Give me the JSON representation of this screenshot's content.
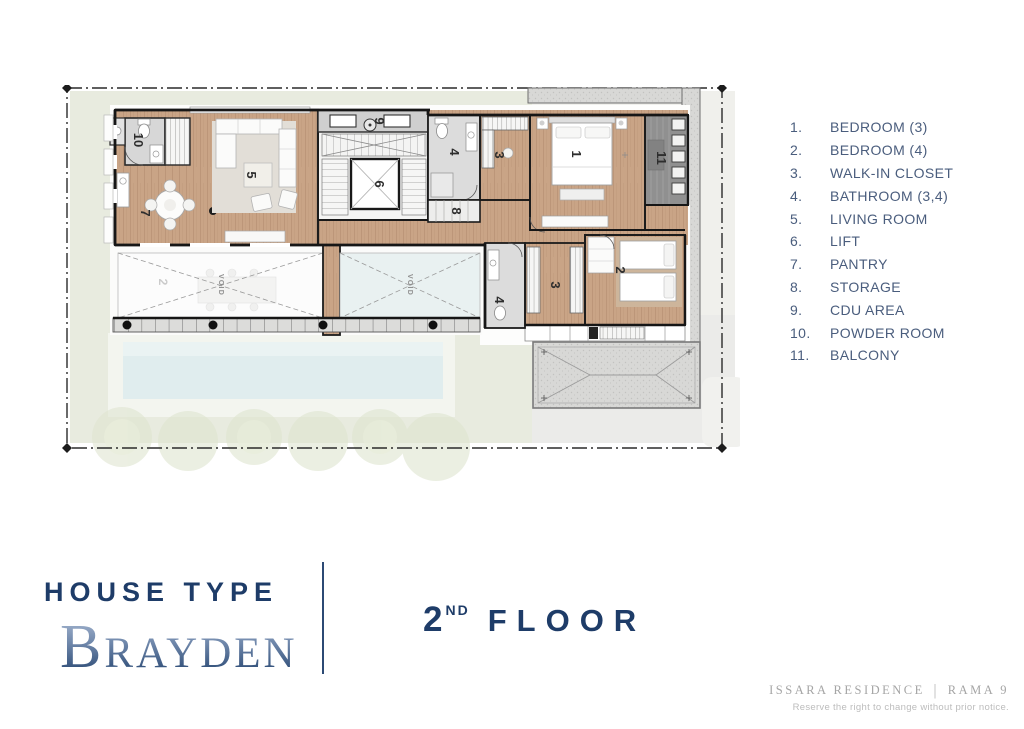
{
  "legend": {
    "items": [
      {
        "num": "1.",
        "label": "BEDROOM (3)"
      },
      {
        "num": "2.",
        "label": "BEDROOM (4)"
      },
      {
        "num": "3.",
        "label": "WALK-IN CLOSET"
      },
      {
        "num": "4.",
        "label": "BATHROOM (3,4)"
      },
      {
        "num": "5.",
        "label": "LIVING ROOM"
      },
      {
        "num": "6.",
        "label": "LIFT"
      },
      {
        "num": "7.",
        "label": "PANTRY"
      },
      {
        "num": "8.",
        "label": "STORAGE"
      },
      {
        "num": "9.",
        "label": "CDU AREA"
      },
      {
        "num": "10.",
        "label": "POWDER ROOM"
      },
      {
        "num": "11.",
        "label": "BALCONY"
      }
    ]
  },
  "plan": {
    "rooms": {
      "bedroom3_num": "1",
      "bedroom4_num": "2",
      "walkin_top_num": "3",
      "walkin_bottom_num": "3",
      "bath_top_num": "4",
      "bath_bottom_num": "4",
      "living_num": "5",
      "lift_num": "6",
      "pantry_num": "7",
      "storage_num": "8",
      "cdu_num": "9",
      "powder_num": "10",
      "balcony_num": "11"
    },
    "void_label": "VOID",
    "ghost_label": "2"
  },
  "titles": {
    "house_type": "HOUSE TYPE",
    "name_initial": "B",
    "name_rest": "RAYDEN",
    "floor_number": "2",
    "floor_ordinal": "ND",
    "floor_word": "FLOOR"
  },
  "footer": {
    "project_name": "ISSARA RESIDENCE",
    "separator": "|",
    "project_area": "RAMA 9",
    "disclaimer": "Reserve the right to change without prior notice."
  },
  "colors": {
    "navy": "#1e3c68",
    "legend_text": "#4a5d7d",
    "wood": "#c9a486",
    "pool": "#e0edee",
    "lawn": "#e8ebdf",
    "balcony_gray": "#909090",
    "footer_gray": "#a5a5a5"
  }
}
